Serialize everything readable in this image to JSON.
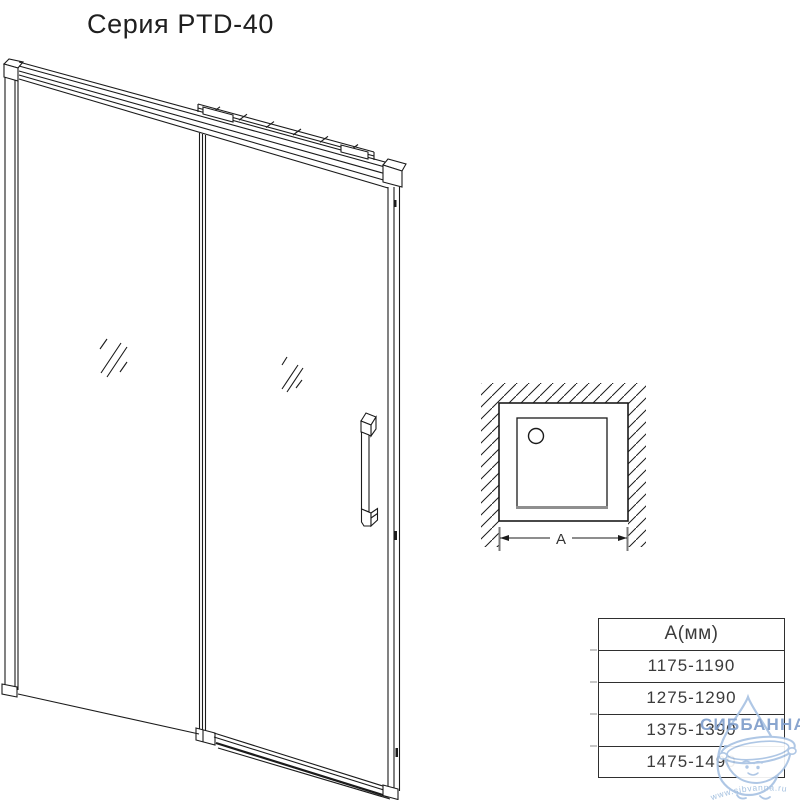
{
  "title": "Серия PTD-40",
  "figures": {
    "door_view": "sliding-shower-door-perspective-line-drawing",
    "top_view": {
      "dimension_label": "A"
    }
  },
  "table": {
    "header": "А(мм)",
    "rows": [
      "1175-1190",
      "1275-1290",
      "1375-1390",
      "1475-1490"
    ]
  },
  "watermark": {
    "brand": "СИББАННА",
    "url": "www.sibvanna.ru"
  },
  "colors": {
    "line": "#1b1b1b",
    "gray_line": "#8f8f8f",
    "table_border": "#2f2f2f",
    "text": "#3b3b3b",
    "watermark_text": "#7f9ecb",
    "watermark_outline": "#a9c3e3"
  }
}
